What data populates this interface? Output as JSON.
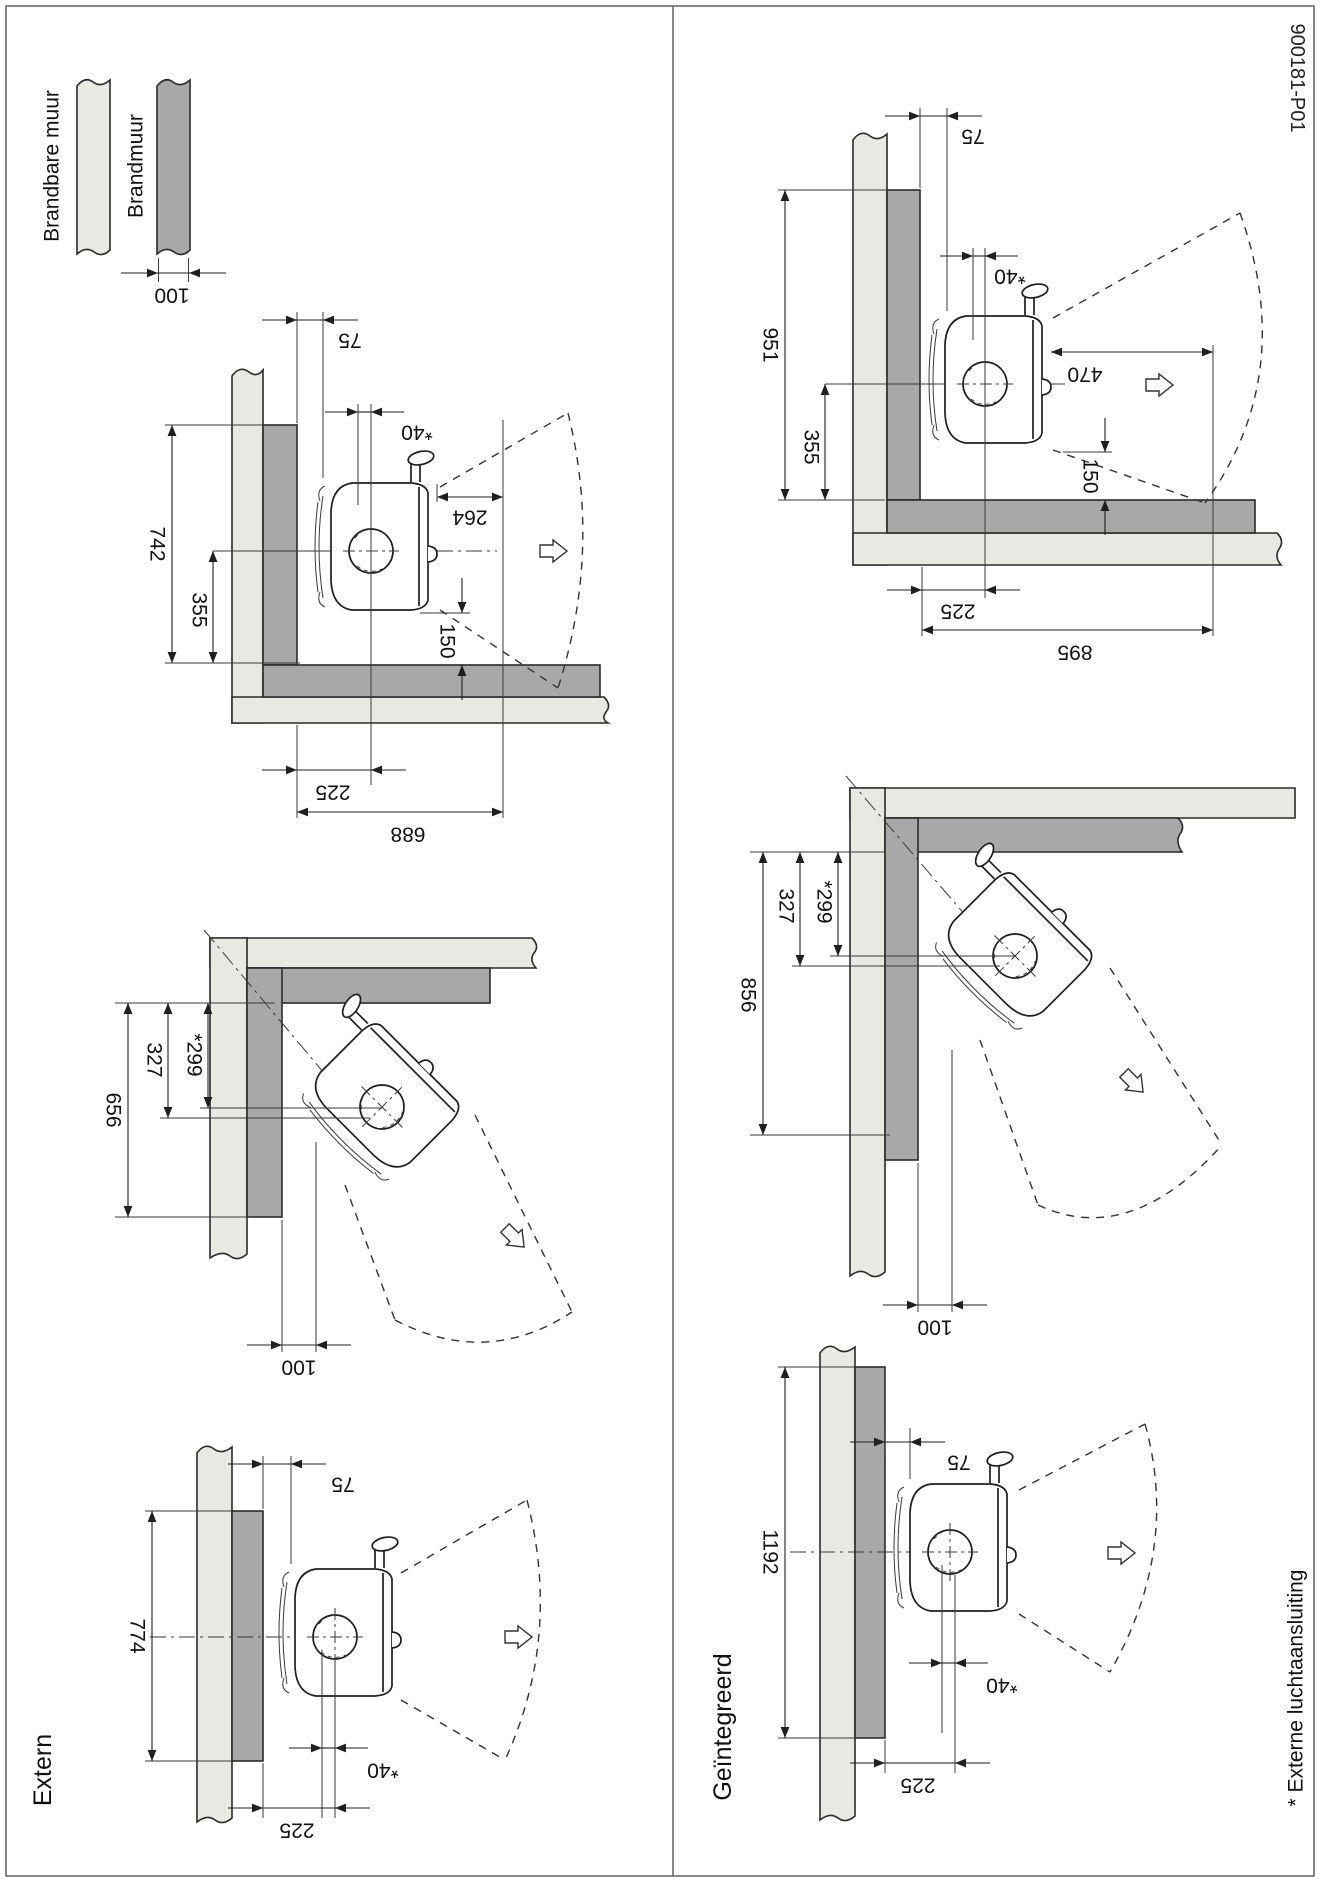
{
  "doc_number": "900181-P01",
  "footnote": "* Externe luchtaansluiting",
  "columns": {
    "left_label": "Extern",
    "right_label": "Geïntegreerd"
  },
  "legend": {
    "combustible_label": "Brandbare muur",
    "firewall_label": "Brandmuur",
    "firewall_thickness": "100"
  },
  "colors": {
    "combustible_wall": "#e9e9e4",
    "firewall": "#a8a8a8",
    "line": "#1f1f1f"
  },
  "extern": {
    "corner": {
      "height_total": "742",
      "height_center": "355",
      "back_clearance": "75",
      "flue_offset": "*40",
      "front_clearance": "264",
      "bottom_clearance": "150",
      "side_distance": "225",
      "width_total": "688"
    },
    "diagonal": {
      "depth_total": "656",
      "depth_upper": "327",
      "depth_inner": "*299",
      "wall_gap": "100"
    },
    "flat": {
      "firewall_height": "774",
      "back_clearance": "75",
      "flue_offset": "*40",
      "side_distance": "225"
    }
  },
  "geintegreerd": {
    "corner": {
      "height_total": "951",
      "height_center": "355",
      "back_clearance": "75",
      "flue_offset": "*40",
      "front_clearance": "470",
      "bottom_clearance": "150",
      "side_distance": "225",
      "width_total": "895"
    },
    "diagonal": {
      "depth_total": "856",
      "depth_upper": "327",
      "depth_inner": "*299",
      "wall_gap": "100"
    },
    "flat": {
      "firewall_height": "1192",
      "back_clearance": "75",
      "flue_offset": "*40",
      "side_distance": "225"
    }
  }
}
